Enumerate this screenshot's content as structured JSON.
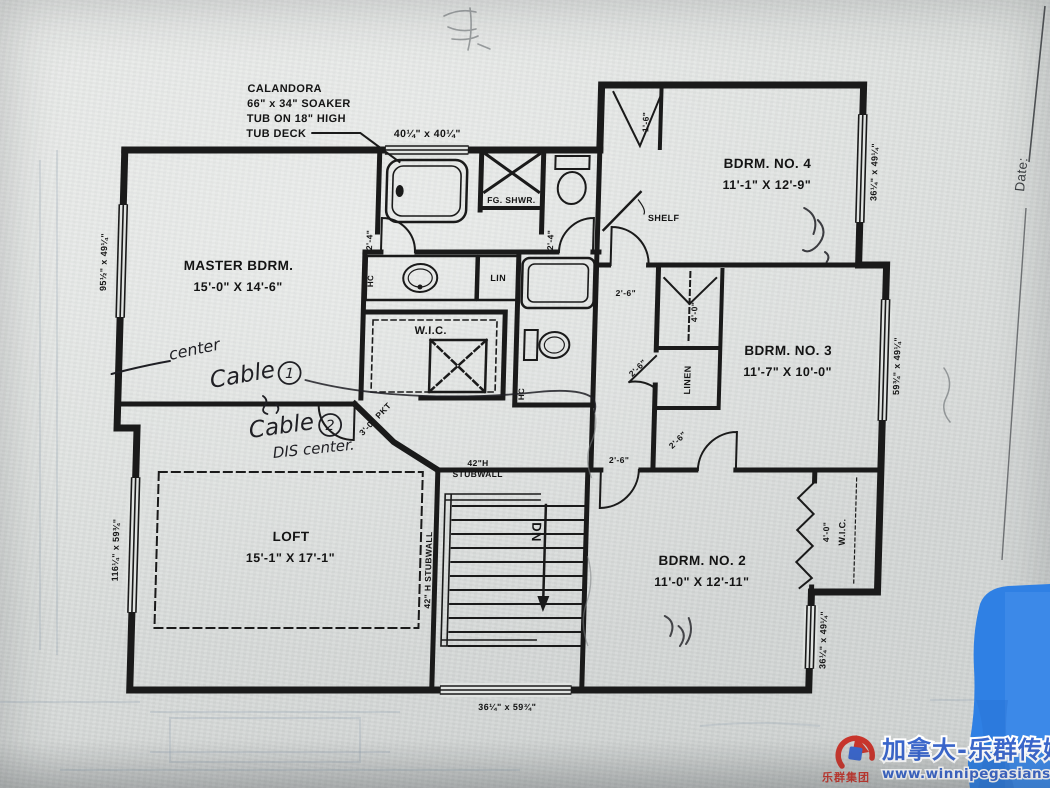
{
  "page": {
    "width": 1050,
    "height": 788
  },
  "colors": {
    "paper": "#dfe2e0",
    "ink": "#1a1a1a",
    "pen": "#1f1f24",
    "blue_patch": "#2f80e4",
    "brand_blue": "#3a66cc",
    "brand_red": "#c8352c"
  },
  "note": {
    "line1": "CALANDORA",
    "line2": "66\" x 34\" SOAKER",
    "line3": "TUB ON 18\" HIGH",
    "line4": "TUB DECK"
  },
  "rooms": {
    "master": {
      "name": "MASTER BDRM.",
      "dims": "15'-0\" X 14'-6\""
    },
    "bdrm4": {
      "name": "BDRM. NO. 4",
      "dims": "11'-1\" X 12'-9\""
    },
    "bdrm3": {
      "name": "BDRM. NO. 3",
      "dims": "11'-7\" X 10'-0\""
    },
    "bdrm2": {
      "name": "BDRM. NO. 2",
      "dims": "11'-0\" X 12'-11\""
    },
    "loft": {
      "name": "LOFT",
      "dims": "15'-1\" X 17'-1\""
    }
  },
  "labels": {
    "wic_master": "W.I.C.",
    "wic_bdrm2": "W.I.C.",
    "lin": "LIN",
    "linen": "LINEN",
    "shelf": "SHELF",
    "shower": "FG. SHWR.",
    "hc_master": "HC",
    "hc_hall": "HC"
  },
  "stairs": {
    "dn": "DN",
    "stub_line1": "42\"H",
    "stub_line2": "STUBWALL",
    "stub_side": "42\" H STUBWALL"
  },
  "windows": {
    "tub": "40¼\" x 40¼\"",
    "master_left": "95½\" x 49¼\"",
    "loft_left": "116¼\" x 59¾\"",
    "bdrm4_right": "36¼\" x 49¼\"",
    "bdrm3_right": "59¾\" x 49¼\"",
    "bdrm2_right": "36¼\" x 49¼\"",
    "stairs_bottom": "36¼\" x 59¾\""
  },
  "doors": {
    "master_bath": "2'-4\"",
    "hall_bath": "2'-4\"",
    "bdrm4": "2'-6\"",
    "bdrm3": "2'-6\"",
    "bdrm2": "2'-6\"",
    "linen": "2'-6\"",
    "closet_bdrm3": "4'-0\"",
    "closet_bdrm4": "1'-6\"",
    "wic_bdrm2": "4'-0\"",
    "pocket": "3'-0\" PKT"
  },
  "handwriting": {
    "center": "center",
    "cable": "Cable",
    "one": "1",
    "two": "2",
    "dis": "DIS center."
  },
  "titleblock": {
    "date": "Date:"
  },
  "watermark": {
    "brand": "加拿大-乐群传媒",
    "url": "www.winnipegasians.com",
    "logo_text": "乐群集团"
  }
}
